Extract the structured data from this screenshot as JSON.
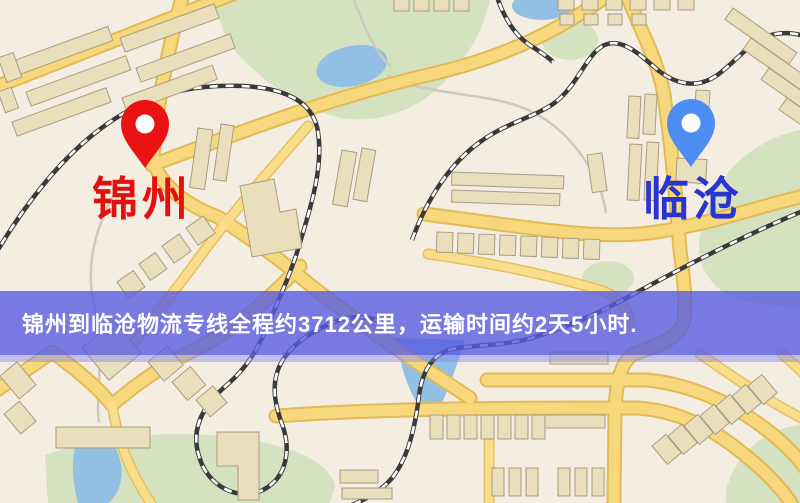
{
  "map": {
    "origin": {
      "label": "锦州",
      "pin_color": "#ea1212",
      "label_color": "#e31010"
    },
    "destination": {
      "label": "临沧",
      "pin_color": "#4e8ef2",
      "label_color": "#2a35cf"
    },
    "palette": {
      "background": "#f4eee2",
      "road_yellow": "#f8d87d",
      "park_green": "#d5e2c0",
      "water_blue": "#92bfe4",
      "building_beige": "#e9dfbc",
      "railway_dark": "#3a3a3a"
    }
  },
  "banner": {
    "text": "锦州到临沧物流专线全程约3712公里，运输时间约2天5小时.",
    "background": "#585cdf",
    "text_color": "#ffffff"
  }
}
